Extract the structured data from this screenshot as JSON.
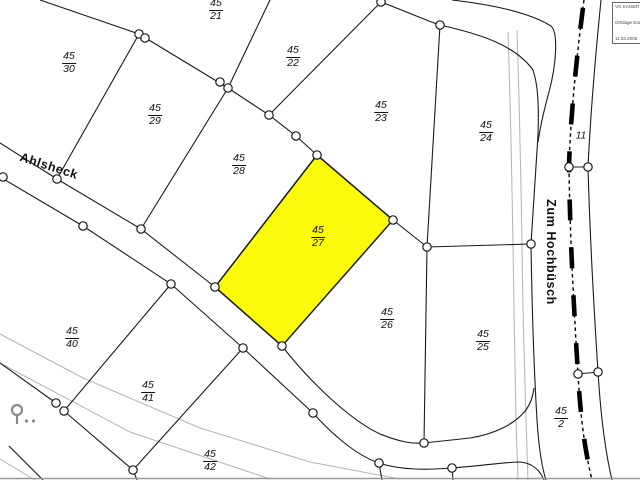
{
  "map": {
    "type": "cadastral-parcel-map",
    "highlight_color": "#fafa0a",
    "line_color": "#1b1b1b",
    "selected_parcel": "45/27",
    "parcel_labels": [
      {
        "label_top": "45",
        "label_bottom": "21",
        "x": 216,
        "y": 10,
        "highlighted": false
      },
      {
        "label_top": "45",
        "label_bottom": "30",
        "x": 69,
        "y": 63,
        "highlighted": false
      },
      {
        "label_top": "45",
        "label_bottom": "22",
        "x": 293,
        "y": 57,
        "highlighted": false
      },
      {
        "label_top": "45",
        "label_bottom": "29",
        "x": 155,
        "y": 115,
        "highlighted": false
      },
      {
        "label_top": "45",
        "label_bottom": "23",
        "x": 381,
        "y": 112,
        "highlighted": false
      },
      {
        "label_top": "45",
        "label_bottom": "24",
        "x": 486,
        "y": 132,
        "highlighted": false
      },
      {
        "label_top": "45",
        "label_bottom": "28",
        "x": 239,
        "y": 165,
        "highlighted": false
      },
      {
        "label_top": "45",
        "label_bottom": "27",
        "x": 318,
        "y": 237,
        "highlighted": true
      },
      {
        "label_top": "45",
        "label_bottom": "26",
        "x": 387,
        "y": 319,
        "highlighted": false
      },
      {
        "label_top": "45",
        "label_bottom": "25",
        "x": 483,
        "y": 341,
        "highlighted": false
      },
      {
        "label_top": "45",
        "label_bottom": "40",
        "x": 72,
        "y": 338,
        "highlighted": false
      },
      {
        "label_top": "45",
        "label_bottom": "41",
        "x": 148,
        "y": 392,
        "highlighted": false
      },
      {
        "label_top": "45",
        "label_bottom": "42",
        "x": 210,
        "y": 461,
        "highlighted": false
      },
      {
        "label_top": "45",
        "label_bottom": "2",
        "x": 561,
        "y": 418,
        "highlighted": false
      }
    ],
    "street_labels": [
      {
        "id": "ahlsheck",
        "text": "Ahlsheck",
        "x": 49,
        "y": 166,
        "rotation": 18
      },
      {
        "id": "zum-hochbuesch",
        "text": "Zum Hochbüsch",
        "x": 551,
        "y": 252,
        "rotation": 90
      }
    ],
    "house_number": {
      "text": "11",
      "x": 581,
      "y": 136
    },
    "info_box": {
      "lines": [
        "VG KAISER",
        "Ortslage  Dorf",
        "11.03.2008"
      ]
    }
  }
}
